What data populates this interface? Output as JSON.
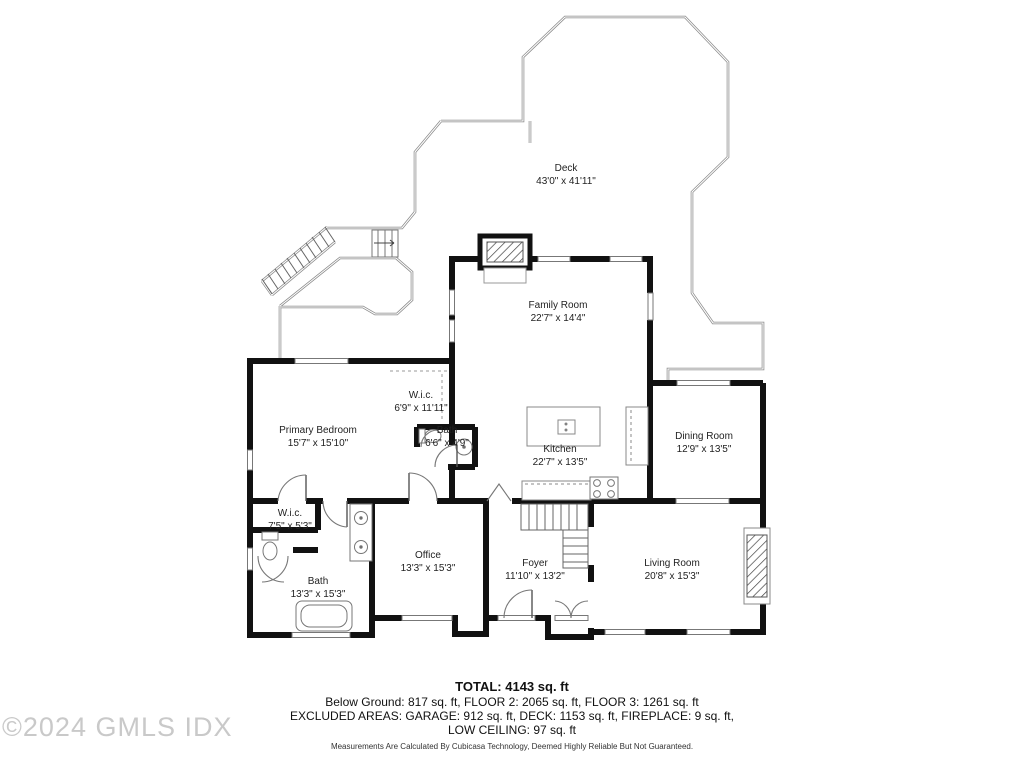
{
  "watermark": "©2024 GMLS IDX",
  "rooms": [
    {
      "id": "deck",
      "name": "Deck",
      "dims": "43'0\" x 41'11\""
    },
    {
      "id": "family-room",
      "name": "Family Room",
      "dims": "22'7\" x 14'4\""
    },
    {
      "id": "wic-upper",
      "name": "W.i.c.",
      "dims": "6'9\" x 11'11\""
    },
    {
      "id": "bath-upper",
      "name": "Bath",
      "dims": "6'6\" x 4'9\""
    },
    {
      "id": "primary-bedroom",
      "name": "Primary Bedroom",
      "dims": "15'7\" x 15'10\""
    },
    {
      "id": "kitchen",
      "name": "Kitchen",
      "dims": "22'7\" x 13'5\""
    },
    {
      "id": "dining-room",
      "name": "Dining Room",
      "dims": "12'9\" x 13'5\""
    },
    {
      "id": "wic-lower",
      "name": "W.i.c.",
      "dims": "7'5\" x 5'3\""
    },
    {
      "id": "bath-lower",
      "name": "Bath",
      "dims": "13'3\" x 15'3\""
    },
    {
      "id": "office",
      "name": "Office",
      "dims": "13'3\" x 15'3\""
    },
    {
      "id": "foyer",
      "name": "Foyer",
      "dims": "11'10\" x 13'2\""
    },
    {
      "id": "living-room",
      "name": "Living Room",
      "dims": "20'8\" x 15'3\""
    }
  ],
  "summary": {
    "total": "TOTAL: 4143 sq. ft",
    "line1": "Below Ground: 817 sq. ft, FLOOR 2: 2065 sq. ft, FLOOR 3: 1261 sq. ft",
    "line2": "EXCLUDED AREAS: GARAGE: 912 sq. ft, DECK: 1153 sq. ft, FIREPLACE: 9 sq. ft,",
    "line3": "LOW CEILING: 97 sq. ft",
    "disclaimer": "Measurements Are Calculated By Cubicasa Technology, Deemed Highly Reliable But Not Guaranteed."
  },
  "colors": {
    "wall": "#111111",
    "thin": "#777777",
    "rail": "#8a8a8a",
    "label": "#222222",
    "watermark": "#c9c9c9"
  }
}
